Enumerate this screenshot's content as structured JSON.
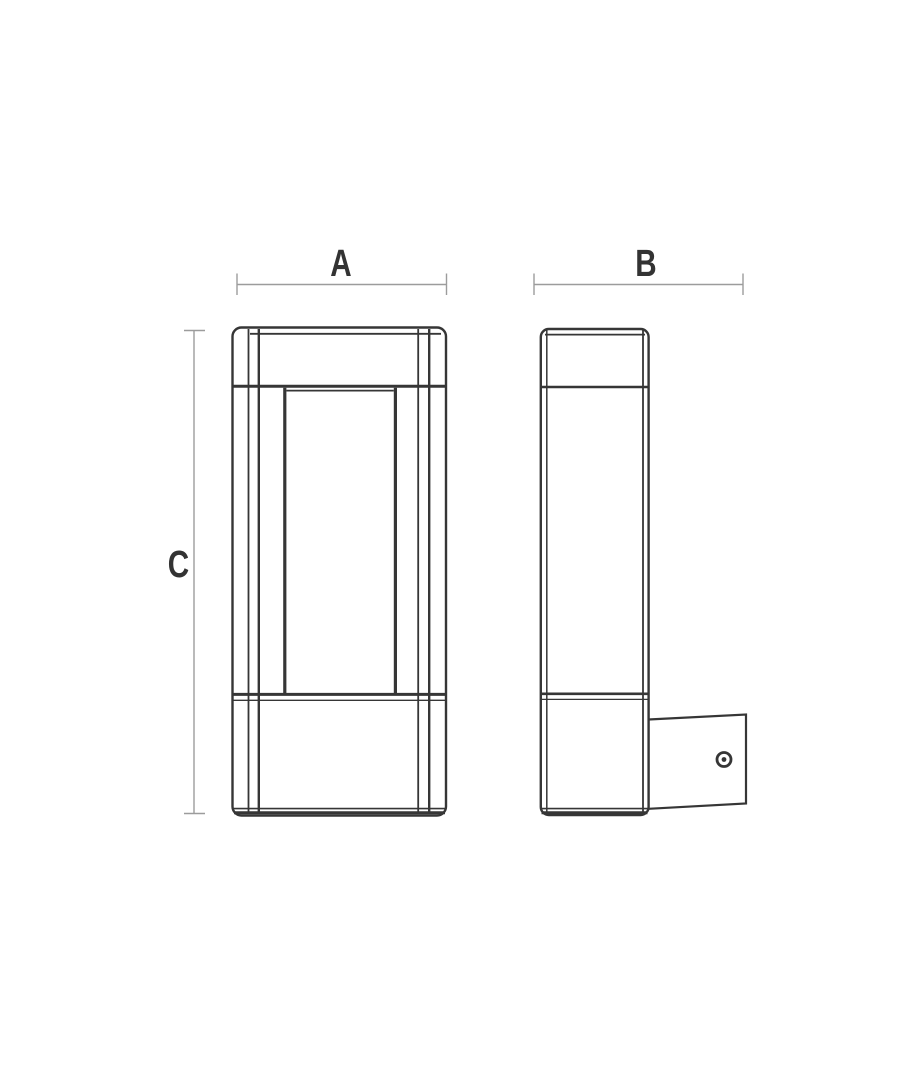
{
  "page": {
    "background": "#ffffff"
  },
  "drawing": {
    "type": "technical-dimension-diagram",
    "subject": "rectangular wall luminaire line drawing",
    "views": [
      {
        "id": "front",
        "description": "front elevation with recessed center panel"
      },
      {
        "id": "side",
        "description": "side elevation with wall-mount bracket and screw"
      }
    ],
    "labels": {
      "width": "A",
      "depth": "B",
      "height": "C"
    },
    "colors": {
      "outline": "#363636",
      "dimension_line": "#9c9c9c",
      "label_text": "#333333",
      "background": "#ffffff"
    }
  }
}
